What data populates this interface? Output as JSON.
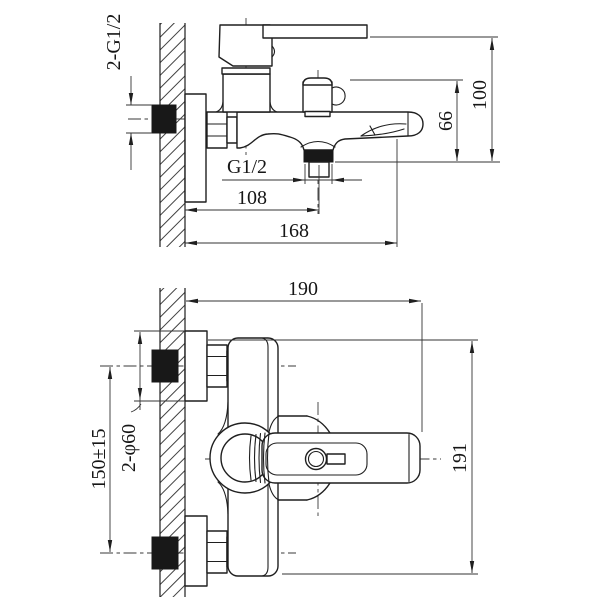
{
  "drawing": {
    "kind": "wall-mounted bath mixer faucet installation drawing",
    "background": "#ffffff",
    "line_color": "#1f1f1f"
  },
  "dimensions": {
    "side_view": {
      "wall_connections": "2-G1/2",
      "shower_outlet_thread": "G1/2",
      "wall_to_outlet_center": "108",
      "wall_to_spout_end": "168",
      "outlet_to_diverter_top": "66",
      "outlet_to_handle_top": "100"
    },
    "plan_view": {
      "wall_to_handle_end": "190",
      "body_overall_width": "191",
      "inlet_centers_spacing": "150±15",
      "escutcheon_diameter": "2-φ60"
    }
  }
}
